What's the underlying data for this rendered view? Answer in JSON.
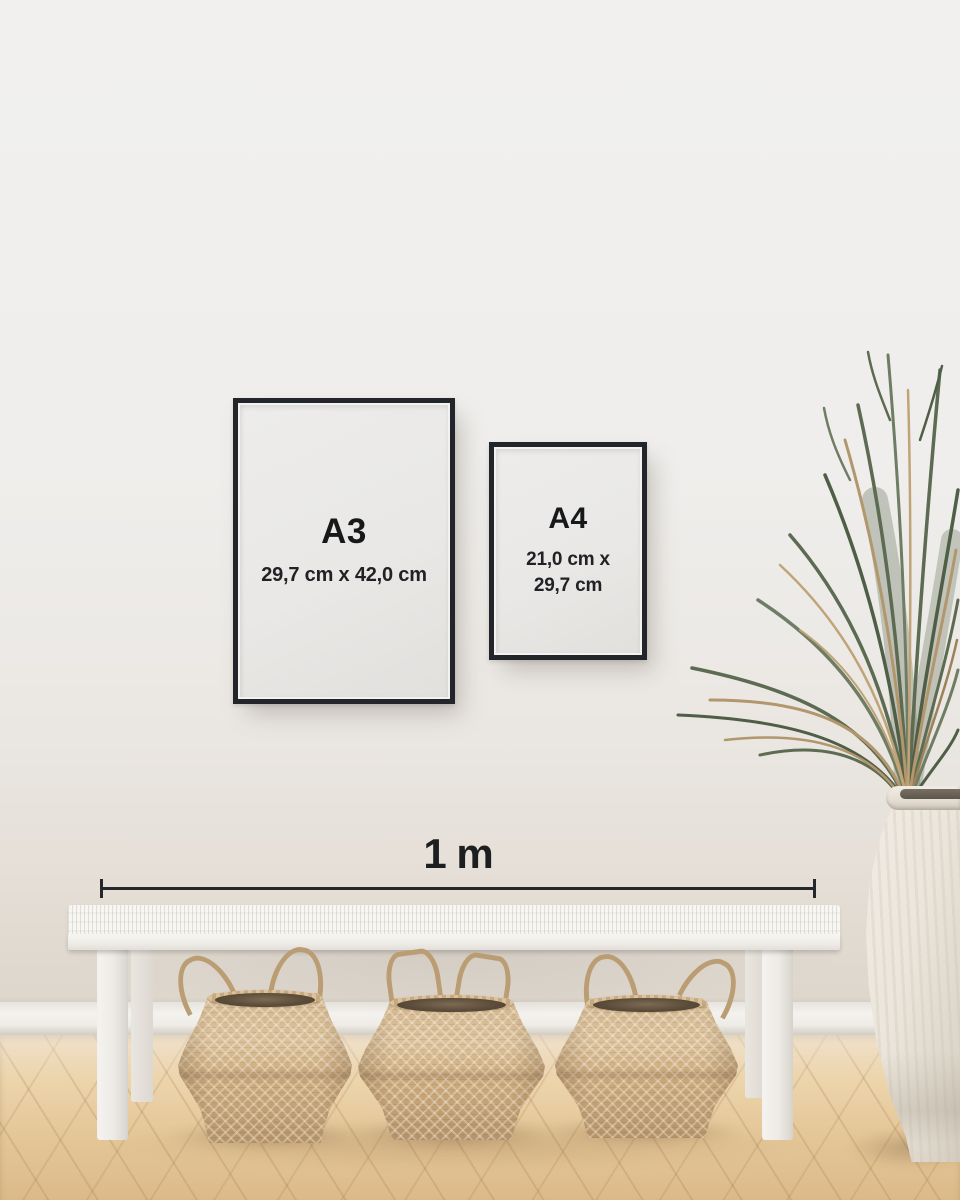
{
  "frames": [
    {
      "label": "A3",
      "dimensions": "29,7 cm x 42,0 cm"
    },
    {
      "label": "A4",
      "dimensions_line1": "21,0 cm x",
      "dimensions_line2": "29,7 cm"
    }
  ],
  "scale": {
    "label": "1 m"
  },
  "colors": {
    "frame_border": "#22252a",
    "frame_paper": "#e9e8e6",
    "text": "#1b1c1e",
    "scale_bar": "#25272a",
    "wall": "#efeeec",
    "baseboard": "#f4f2ee",
    "floor_wood": "#e4c697",
    "bench_white": "#f5f3f0",
    "basket_tan": "#cdad81",
    "basket_opening": "#5c4d3b",
    "plant_green": "#5c6b51",
    "plant_dried": "#b2966d",
    "vase_cream": "#ebe5db"
  }
}
